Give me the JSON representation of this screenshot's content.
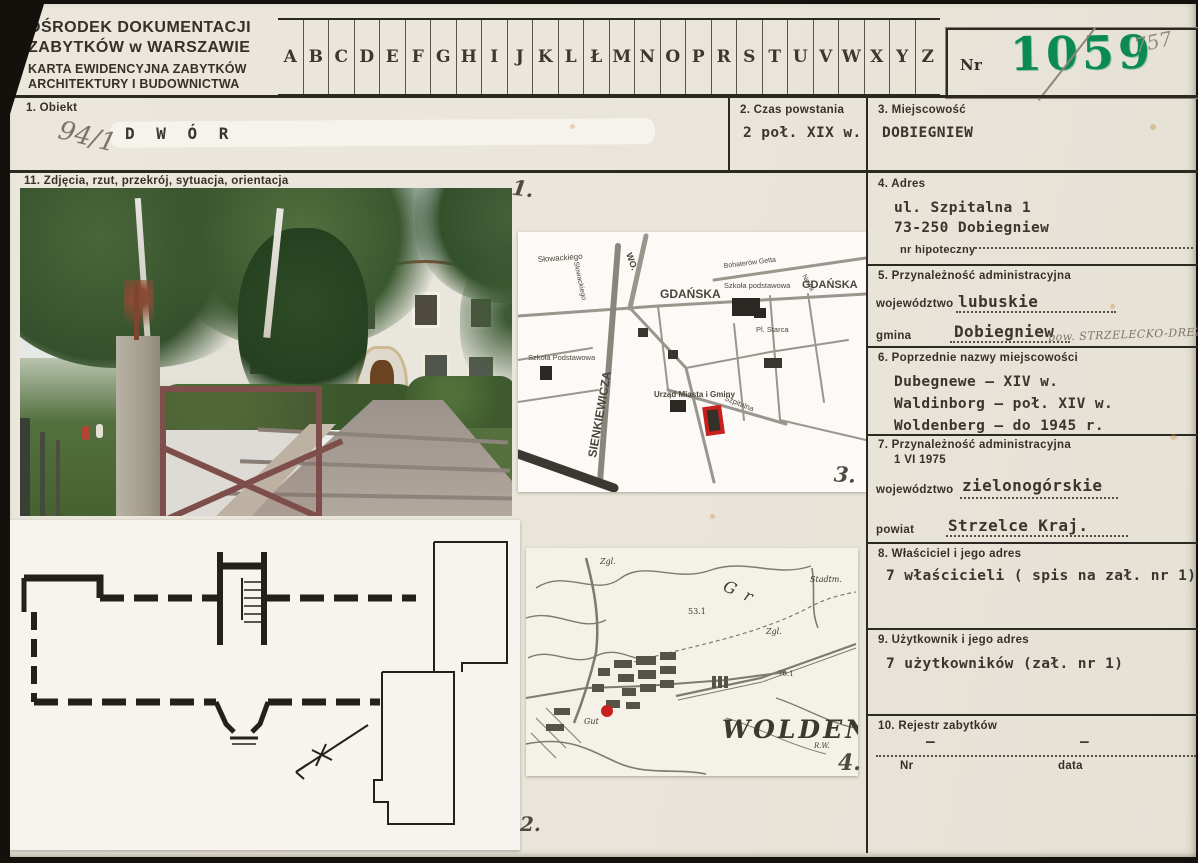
{
  "header": {
    "org_line1": "OŚRODEK DOKUMENTACJI",
    "org_line2": "ZABYTKÓW w WARSZAWIE",
    "card_line1": "KARTA EWIDENCYJNA ZABYTKÓW",
    "card_line2": "ARCHITEKTURY I BUDOWNICTWA",
    "nr_label": "Nr",
    "nr_value": "1059",
    "nr_pencil": "757"
  },
  "alphabet": [
    "A",
    "B",
    "C",
    "D",
    "E",
    "F",
    "G",
    "H",
    "I",
    "J",
    "K",
    "L",
    "Ł",
    "M",
    "N",
    "O",
    "P",
    "R",
    "S",
    "T",
    "U",
    "V",
    "W",
    "X",
    "Y",
    "Z"
  ],
  "sections": {
    "s1": {
      "label": "1.  Obiekt",
      "value": "D W Ó R",
      "pencil_note": "94/1"
    },
    "s2": {
      "label": "2.  Czas powstania",
      "value": "2 poł. XIX w."
    },
    "s3": {
      "label": "3.  Miejscowość",
      "value": "DOBIEGNIEW"
    },
    "s4": {
      "label": "4.  Adres",
      "line1": "ul. Szpitalna 1",
      "line2": "73-250 Dobiegniew",
      "sub_label": "nr hipoteczny"
    },
    "s5": {
      "label": "5.  Przynależność administracyjna",
      "f1_label": "województwo",
      "f1_value": "lubuskie",
      "f2_label": "gmina",
      "f2_value": "Dobiegniew",
      "pencil_note": "pow. STRZELECKO-DREZD."
    },
    "s6": {
      "label": "6.  Poprzednie nazwy miejscowości",
      "line1": "Dubegnewe – XIV w.",
      "line2": "Waldinborg – poł. XIV w.",
      "line3": "Woldenberg – do 1945 r."
    },
    "s7": {
      "label": "7.  Przynależność administracyjna",
      "label2": "1 VI 1975",
      "f1_label": "województwo",
      "f1_value": "zielonogórskie",
      "f2_label": "powiat",
      "f2_value": "Strzelce Kraj."
    },
    "s8": {
      "label": "8.  Właściciel i jego adres",
      "value": "7 właścicieli ( spis na zał. nr 1)"
    },
    "s9": {
      "label": "9.  Użytkownik i jego adres",
      "value": "7 użytkowników (zał. nr 1)"
    },
    "s10": {
      "label": "10. Rejestr zabytków",
      "nr_label": "Nr",
      "data_label": "data",
      "dash1": "–",
      "dash2": "–"
    },
    "s11": {
      "label": "11.  Zdjęcia, rzut, przekrój, sytuacja, orientacja"
    }
  },
  "annotations": {
    "photo": "1.",
    "plan": "2.",
    "city_map": "3.",
    "topo_map": "4."
  },
  "city_map_labels": {
    "wo": "WO.",
    "slowackiego_h": "Słowackiego",
    "slowackiego_v": "Słowackiego",
    "gdanska_center": "GDAŃSKA",
    "gdanska_right": "GDAŃSKA",
    "bohaterow": "Bohaterów Getta",
    "nowa": "Nowa",
    "szkola_right": "Szkoła podstawowa",
    "szkola_left": "Szkoła Podstawowa",
    "sienkiewicza": "SIENKIEWICZA",
    "urzad": "Urząd Miasta i Gminy",
    "pl_starca": "Pl. Starca",
    "szpitalna": "Szpitalna"
  },
  "topo_map_labels": {
    "title": "WOLDENB",
    "lake": "Gr",
    "h53": "53.1",
    "h70": "70.1",
    "zgl1": "Zgl.",
    "zgl2": "Zgl.",
    "gut": "Gut",
    "stadt": "Stadtm.",
    "rw": "R.W."
  },
  "colors": {
    "stamp_green": "#0c8a55",
    "highlight_red": "#c8201d",
    "pencil_gray": "#7b7569"
  }
}
